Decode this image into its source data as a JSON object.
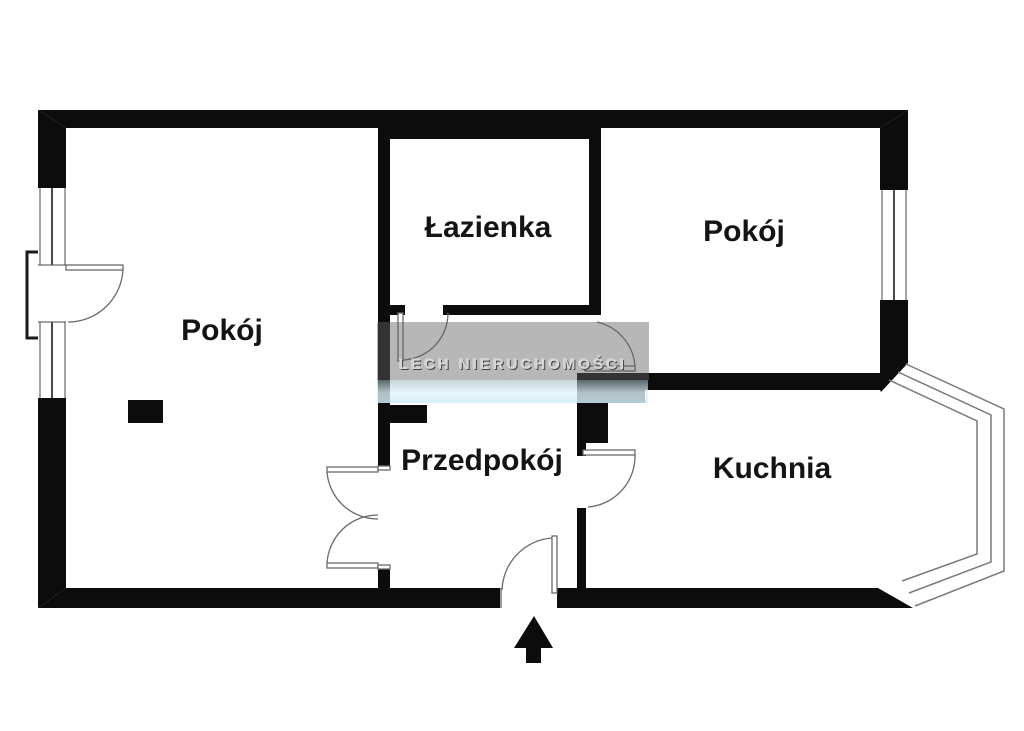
{
  "plan": {
    "type": "apartment-floor-plan",
    "rooms": [
      {
        "id": "pokoj-left",
        "label": "Pokój"
      },
      {
        "id": "lazienka",
        "label": "Łazienka"
      },
      {
        "id": "pokoj-right",
        "label": "Pokój"
      },
      {
        "id": "przedpokoj",
        "label": "Przedpokój"
      },
      {
        "id": "kuchnia",
        "label": "Kuchnia"
      }
    ],
    "features": [
      "entrance-arrow",
      "bay-window",
      "balcony-door",
      "double-door",
      "windows"
    ]
  },
  "watermark": {
    "text": "LECH NIERUCHOMOŚCI"
  },
  "colors": {
    "wall": "#0c0c0c",
    "background": "#ffffff",
    "door_stroke": "#6a6a6a",
    "bay_stroke": "#7a7a7a",
    "label_text": "#141414",
    "watermark_band": "rgba(98,98,98,0.46)",
    "watermark_text": "#d6d6d6"
  }
}
